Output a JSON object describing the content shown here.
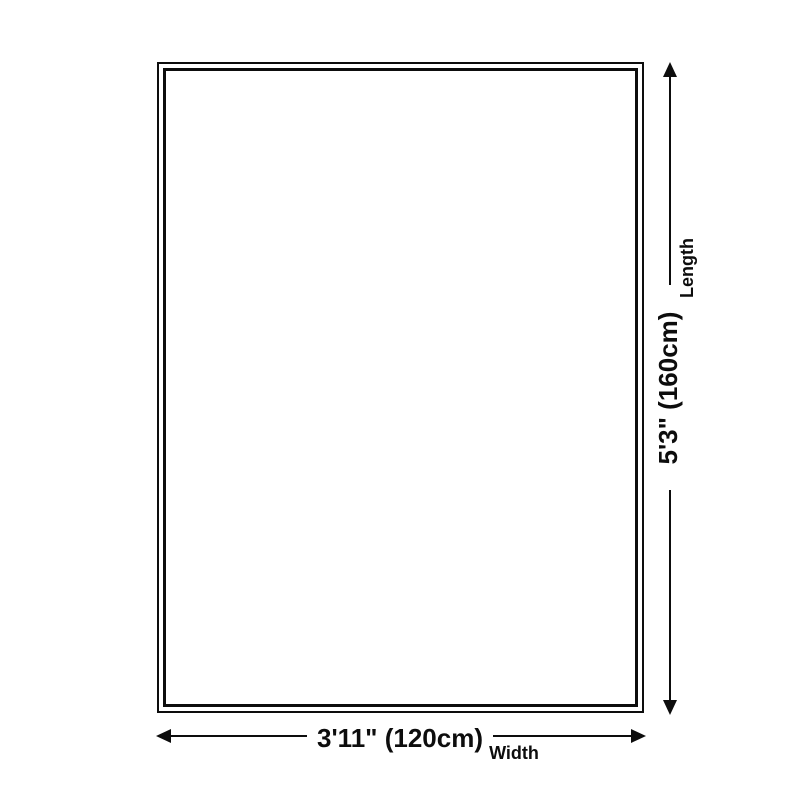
{
  "colors": {
    "ink": "#0d0d0d",
    "background": "#ffffff"
  },
  "dimensions": {
    "length": {
      "label": "Length",
      "value": "5'3\" (160cm)"
    },
    "width": {
      "label": "Width",
      "value": "3'11\" (120cm)"
    }
  }
}
